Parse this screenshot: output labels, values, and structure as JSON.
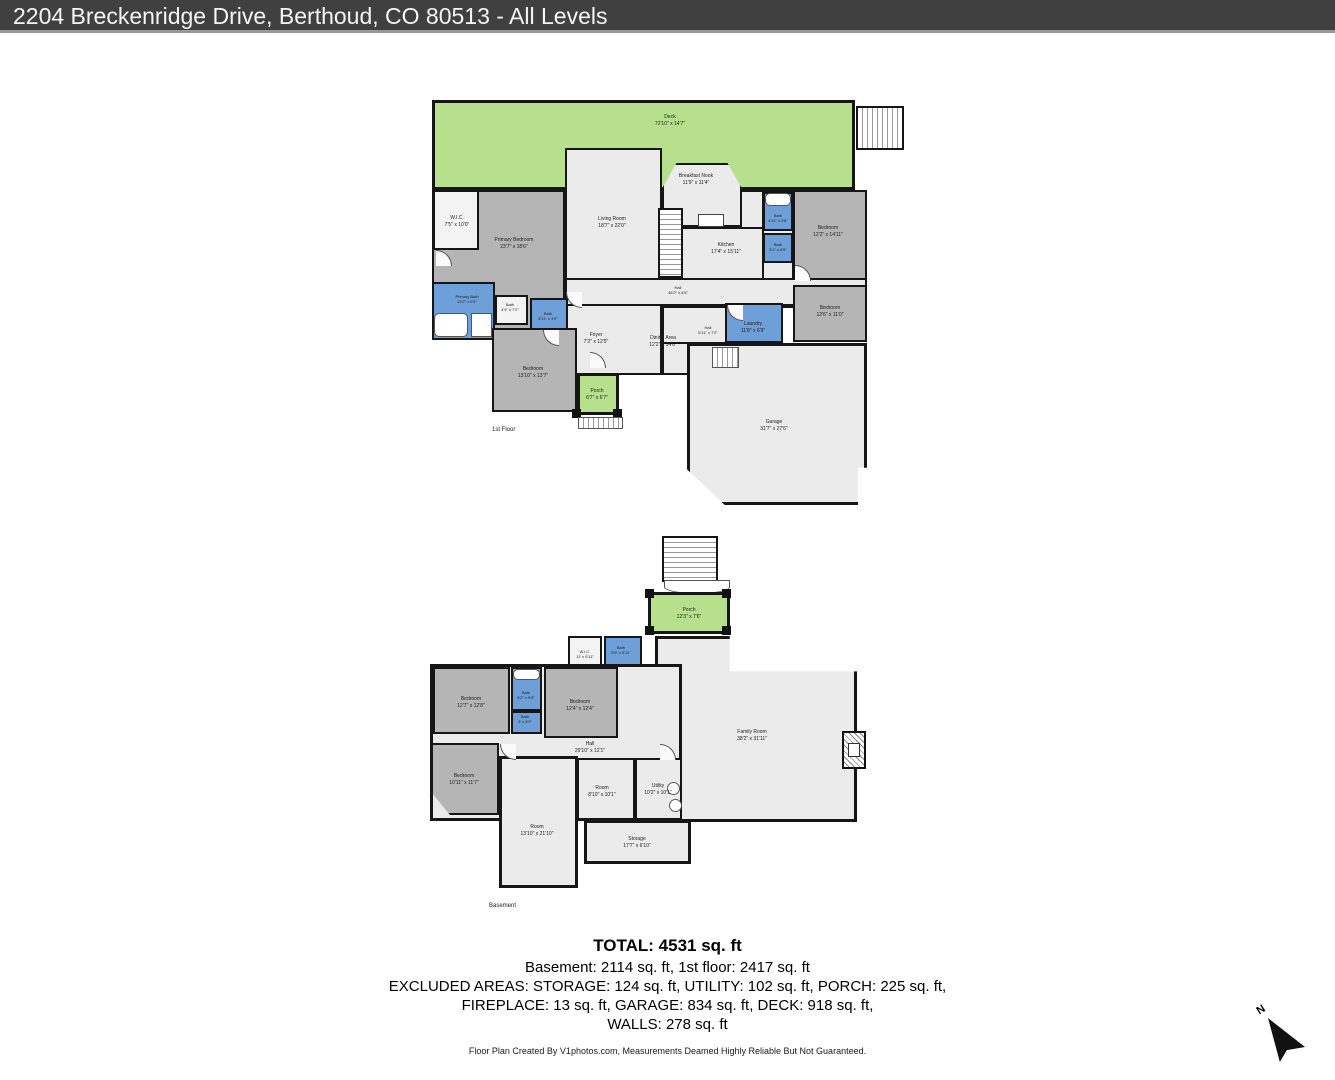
{
  "header": {
    "title": "2204 Breckenridge Drive, Berthoud, CO 80513 - All Levels"
  },
  "floors": [
    {
      "caption": "1st Floor",
      "rooms": [
        {
          "name": "Deck",
          "dims": "72'10\" x 14'7\""
        },
        {
          "name": "W.I.C.",
          "dims": "7'5\" x 10'0\""
        },
        {
          "name": "Primary Bedroom",
          "dims": "23'7\" x 18'6\""
        },
        {
          "name": "Living Room",
          "dims": "18'7\" x 22'0\""
        },
        {
          "name": "Breakfast Nook",
          "dims": "11'9\" x 11'4\""
        },
        {
          "name": "Kitchen",
          "dims": "17'4\" x 15'11\""
        },
        {
          "name": "Bath",
          "dims": "4'11\" x 5'8\""
        },
        {
          "name": "Bath",
          "dims": "5'1\" x 6'5\""
        },
        {
          "name": "Bedroom",
          "dims": "12'2\" x 14'11\""
        },
        {
          "name": "Bedroom",
          "dims": "12'6\" x 11'0\""
        },
        {
          "name": "Hall",
          "dims": "46'2\" x 4'6\""
        },
        {
          "name": "Laundry",
          "dims": "11'8\" x 6'9\""
        },
        {
          "name": "Hall",
          "dims": "5'11\" x 7'2\""
        },
        {
          "name": "Primary Bath",
          "dims": "10'2\" x 9'4\""
        },
        {
          "name": "Bath",
          "dims": "4'9\" x 7'2\""
        },
        {
          "name": "Bath",
          "dims": "8'11\" x 4'9\""
        },
        {
          "name": "Foyer",
          "dims": "7'2\" x 12'5\""
        },
        {
          "name": "Dining Area",
          "dims": "12'2\" x 14'6\""
        },
        {
          "name": "Bedroom",
          "dims": "13'10\" x 13'7\""
        },
        {
          "name": "Porch",
          "dims": "6'7\" x 6'7\""
        },
        {
          "name": "Garage",
          "dims": "31'7\" x 27'6\""
        }
      ]
    },
    {
      "caption": "Basement",
      "rooms": [
        {
          "name": "Porch",
          "dims": "12'3\" x 7'6\""
        },
        {
          "name": "W.I.C.",
          "dims": "11' x 5'11\""
        },
        {
          "name": "Bath",
          "dims": "5'9\" x 5'11\""
        },
        {
          "name": "Bedroom",
          "dims": "12'7\" x 12'8\""
        },
        {
          "name": "Bath",
          "dims": "5'2\" x 5'9\""
        },
        {
          "name": "Bath",
          "dims": "3' x 4'9\""
        },
        {
          "name": "Bedroom",
          "dims": "12'4\" x 12'4\""
        },
        {
          "name": "Hall",
          "dims": "29'10\" x 12'1\""
        },
        {
          "name": "Family Room",
          "dims": "38'2\" x 31'11\""
        },
        {
          "name": "Bedroom",
          "dims": "10'11\" x 11'7\""
        },
        {
          "name": "Room",
          "dims": "8'10\" x 10'1\""
        },
        {
          "name": "Utility",
          "dims": "10'2\" x 10'1\""
        },
        {
          "name": "Room",
          "dims": "13'10\" x 21'10\""
        },
        {
          "name": "Storage",
          "dims": "17'7\" x 6'10\""
        }
      ]
    }
  ],
  "summary": {
    "total": "TOTAL: 4531 sq. ft",
    "line1": "Basement: 2114 sq. ft, 1st floor: 2417 sq. ft",
    "line2": "EXCLUDED AREAS: STORAGE: 124 sq. ft, UTILITY: 102 sq. ft, PORCH: 225 sq. ft,",
    "line3": "FIREPLACE: 13 sq. ft, GARAGE: 834 sq. ft, DECK: 918 sq. ft,",
    "line4": "WALLS: 278 sq. ft"
  },
  "footer": {
    "credit": "Floor Plan Created By V1photos.com, Measurements Deamed Highly Reliable But Not Guaranteed."
  },
  "compass": {
    "label": "N"
  },
  "colors": {
    "header_bg": "#404040",
    "deck_green": "#b6e08c",
    "bedroom_gray": "#b5b5b5",
    "bath_blue": "#6f9fd8",
    "room_light": "#ebebeb",
    "wall": "#161616"
  }
}
